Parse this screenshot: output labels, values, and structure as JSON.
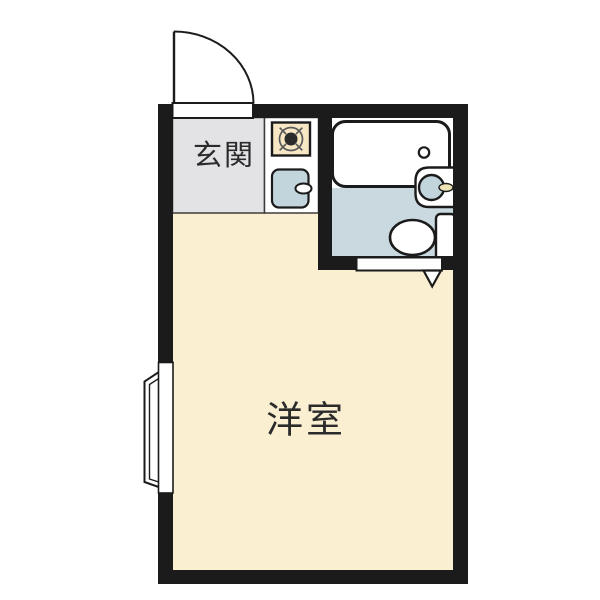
{
  "floor_plan": {
    "rooms": {
      "genkan": {
        "label": "玄関"
      },
      "main_room": {
        "label": "洋室"
      },
      "kitchen": {
        "fixtures": [
          "stove-burner",
          "kitchen-sink"
        ]
      },
      "bathroom": {
        "fixtures": [
          "bathtub",
          "wash-basin",
          "toilet"
        ]
      }
    },
    "features": [
      "entrance-swing-door",
      "bay-window",
      "bathroom-door",
      "door-swing-arrow"
    ],
    "colors": {
      "wall": "#1b1b1b",
      "room_floor": "#FAEFD1",
      "genkan_floor": "#E3E3E6",
      "bathroom_floor": "#C9D9DF",
      "fixture_blue": "#C3D5DC",
      "stove_top": "#F7E7C5",
      "faucet": "#EDE2B4",
      "white": "#ffffff",
      "text": "#2b2b2b"
    }
  }
}
